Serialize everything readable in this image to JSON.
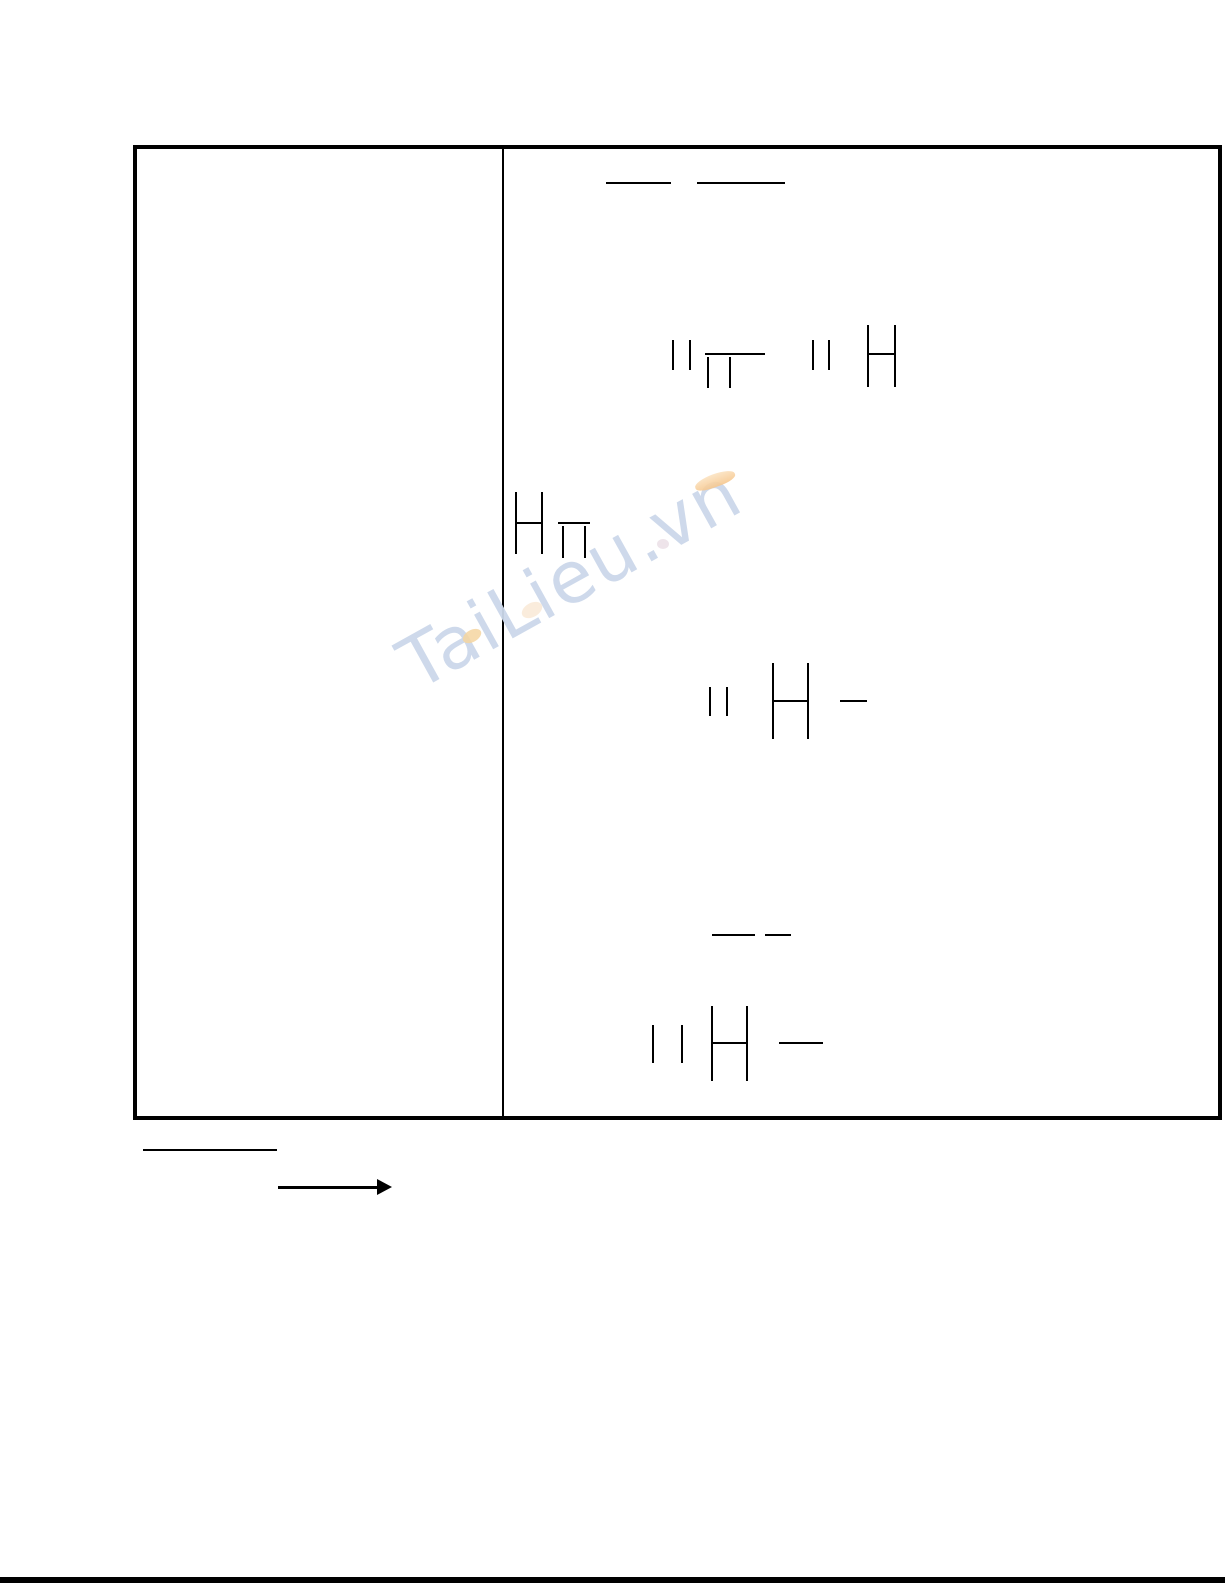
{
  "page": {
    "background": "#ffffff"
  },
  "watermark": {
    "text": "TaiLieu.vn",
    "color": "#ccd8ea",
    "swoosh_color": "#f6c78e",
    "leaf_color": "#f4d5a0",
    "rotation_deg": -29
  },
  "table": {
    "border_color": "#000000",
    "left_cell_text": "",
    "right_cell_text": ""
  },
  "figure": {
    "stroke_color": "#000000",
    "strokes": [
      {
        "name": "h-line",
        "x": 606,
        "y": 182,
        "w": 65,
        "h": 2
      },
      {
        "name": "h-line",
        "x": 697,
        "y": 182,
        "w": 88,
        "h": 2
      },
      {
        "name": "v-line",
        "x": 672,
        "y": 340,
        "w": 2,
        "h": 30
      },
      {
        "name": "v-line",
        "x": 689,
        "y": 340,
        "w": 2,
        "h": 30
      },
      {
        "name": "h-line",
        "x": 705,
        "y": 353,
        "w": 60,
        "h": 2
      },
      {
        "name": "v-line",
        "x": 707,
        "y": 357,
        "w": 2,
        "h": 31
      },
      {
        "name": "v-line",
        "x": 729,
        "y": 357,
        "w": 2,
        "h": 31
      },
      {
        "name": "v-line",
        "x": 812,
        "y": 340,
        "w": 2,
        "h": 30
      },
      {
        "name": "v-line",
        "x": 828,
        "y": 340,
        "w": 2,
        "h": 30
      },
      {
        "name": "v-line",
        "x": 867,
        "y": 325,
        "w": 2,
        "h": 62
      },
      {
        "name": "v-line",
        "x": 894,
        "y": 325,
        "w": 2,
        "h": 62
      },
      {
        "name": "h-line",
        "x": 869,
        "y": 353,
        "w": 25,
        "h": 2
      },
      {
        "name": "v-line",
        "x": 515,
        "y": 492,
        "w": 2,
        "h": 62
      },
      {
        "name": "v-line",
        "x": 541,
        "y": 492,
        "w": 2,
        "h": 62
      },
      {
        "name": "h-line",
        "x": 517,
        "y": 522,
        "w": 24,
        "h": 2
      },
      {
        "name": "h-line",
        "x": 558,
        "y": 522,
        "w": 32,
        "h": 2
      },
      {
        "name": "v-line",
        "x": 562,
        "y": 526,
        "w": 2,
        "h": 32
      },
      {
        "name": "v-line",
        "x": 584,
        "y": 526,
        "w": 2,
        "h": 32
      },
      {
        "name": "v-line",
        "x": 709,
        "y": 687,
        "w": 2,
        "h": 29
      },
      {
        "name": "v-line",
        "x": 726,
        "y": 687,
        "w": 2,
        "h": 29
      },
      {
        "name": "v-line",
        "x": 772,
        "y": 663,
        "w": 2,
        "h": 76
      },
      {
        "name": "v-line",
        "x": 807,
        "y": 663,
        "w": 2,
        "h": 76
      },
      {
        "name": "h-line",
        "x": 774,
        "y": 700,
        "w": 33,
        "h": 2
      },
      {
        "name": "h-line",
        "x": 840,
        "y": 700,
        "w": 27,
        "h": 2
      },
      {
        "name": "h-line",
        "x": 712,
        "y": 934,
        "w": 43,
        "h": 2
      },
      {
        "name": "h-line",
        "x": 765,
        "y": 934,
        "w": 26,
        "h": 2
      },
      {
        "name": "v-line",
        "x": 652,
        "y": 1025,
        "w": 2,
        "h": 38
      },
      {
        "name": "v-line",
        "x": 681,
        "y": 1025,
        "w": 2,
        "h": 38
      },
      {
        "name": "v-line",
        "x": 711,
        "y": 1006,
        "w": 2,
        "h": 75
      },
      {
        "name": "v-line",
        "x": 746,
        "y": 1006,
        "w": 2,
        "h": 75
      },
      {
        "name": "h-line",
        "x": 713,
        "y": 1042,
        "w": 34,
        "h": 2
      },
      {
        "name": "h-line",
        "x": 779,
        "y": 1042,
        "w": 44,
        "h": 2
      }
    ]
  },
  "annotations": {
    "underline": {
      "x": 143,
      "y": 1149,
      "w": 134,
      "h": 2
    },
    "arrow": {
      "x1": 278,
      "x2": 392,
      "y": 1187
    }
  },
  "footer": {
    "rule_color": "#000000"
  }
}
